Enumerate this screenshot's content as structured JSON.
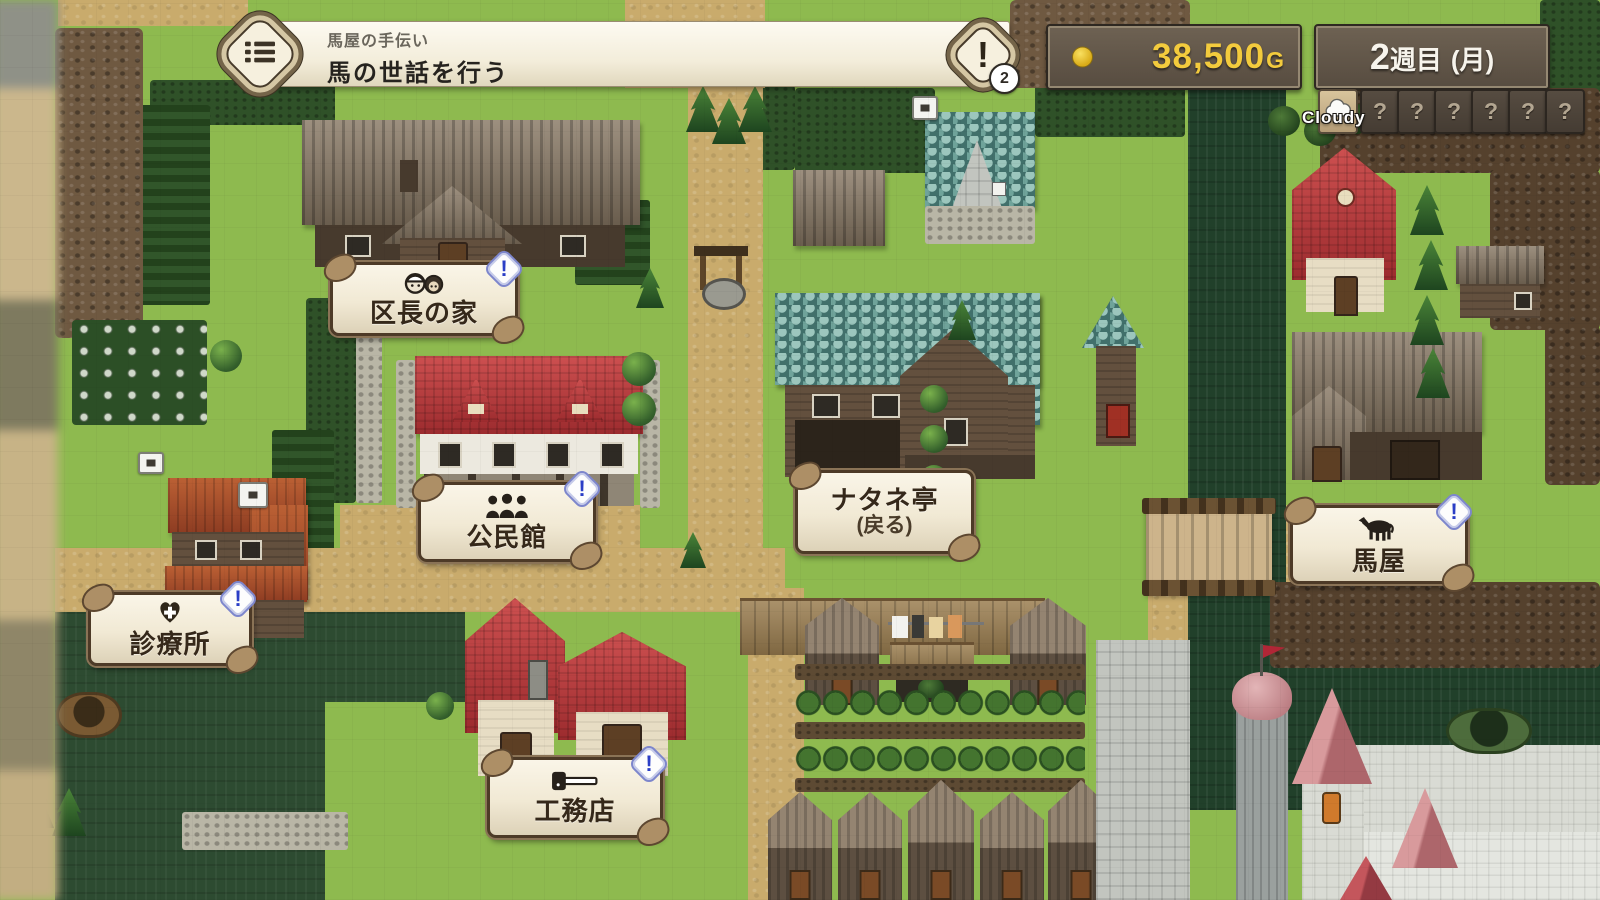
{
  "quest": {
    "title": "馬屋の手伝い",
    "objective": "馬の世話を行う",
    "count_badge": "2"
  },
  "hud": {
    "gold_amount": "38,500",
    "gold_unit": "G",
    "week_number": "2",
    "week_unit": "週目",
    "day_label": "(月)",
    "weather_today": "Cloudy",
    "unknown_days": 6
  },
  "icons": {
    "alert": "!",
    "unknown": "?",
    "quest_log": "list-icon",
    "gold_coin": "coin-icon",
    "weather_today_icon": "cloud-icon",
    "sign_badges": "event-exclamation-icon"
  },
  "map_labels": [
    {
      "name": "区長の家",
      "icon": "two-people-icon",
      "has_badge": true
    },
    {
      "name": "公民館",
      "icon": "three-people-icon",
      "has_badge": true
    },
    {
      "name": "診療所",
      "icon": "heart-cross-icon",
      "has_badge": true
    },
    {
      "name": "ナタネ亭",
      "sub": "(戻る)",
      "icon": "none",
      "has_badge": false
    },
    {
      "name": "工務店",
      "icon": "hammer-icon",
      "has_badge": true
    },
    {
      "name": "馬屋",
      "icon": "horse-icon",
      "has_badge": true
    }
  ],
  "colors": {
    "grass": "#8eba4f",
    "water": "#21402a",
    "path_tan": "#c9ab6c",
    "panel_brown": "#5d5245",
    "gold_text": "#f3cb3d",
    "sign_cream": "#f1e9d4",
    "sign_border": "#4d3a27",
    "badge_blue": "#2b3ec6",
    "roof_red": "#b03032",
    "inn_roof_teal": "#41706b"
  }
}
